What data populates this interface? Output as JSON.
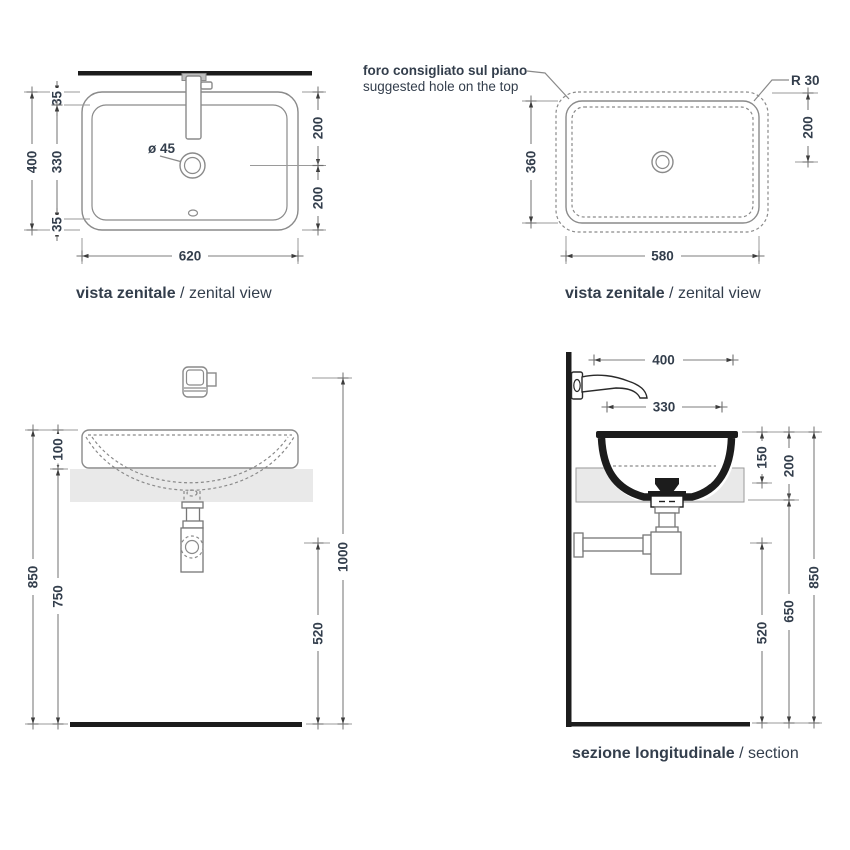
{
  "drawing": {
    "background": "#ffffff",
    "line_color": "#8a8a8a",
    "dark_color": "#1c1c1c",
    "text_color": "#333e4c",
    "counter_color": "#e9e9e9"
  },
  "views": {
    "zenital_basin": {
      "title_main": "vista zenitale",
      "title_sub": " / zenital view",
      "drain_diameter": "ø 45",
      "dim_overall_height": "400",
      "dim_rim_top": "35",
      "dim_inner_height": "330",
      "dim_rim_bottom": "35",
      "dim_right_upper": "200",
      "dim_right_lower": "200",
      "dim_width": "620"
    },
    "zenital_hole": {
      "title_main": "vista zenitale",
      "title_sub": " / zenital view",
      "note_line1": "foro consigliato sul piano",
      "note_line2": "suggested hole on the top",
      "corner_radius": "R 30",
      "dim_height": "360",
      "dim_right_upper": "200",
      "dim_width": "580"
    },
    "front_view": {
      "dim_total_height": "850",
      "dim_rim_to_counter": "100",
      "dim_counter_to_floor": "750",
      "dim_outlet_height": "520",
      "dim_tap_height": "1000"
    },
    "section": {
      "title_main": "sezione longitudinale",
      "title_sub": " / section",
      "dim_tap_depth": "400",
      "dim_basin_depth": "330",
      "dim_basin_height": "150",
      "dim_counter_offset": "200",
      "dim_under_counter": "650",
      "dim_outlet_height": "520",
      "dim_total_height": "850"
    }
  }
}
